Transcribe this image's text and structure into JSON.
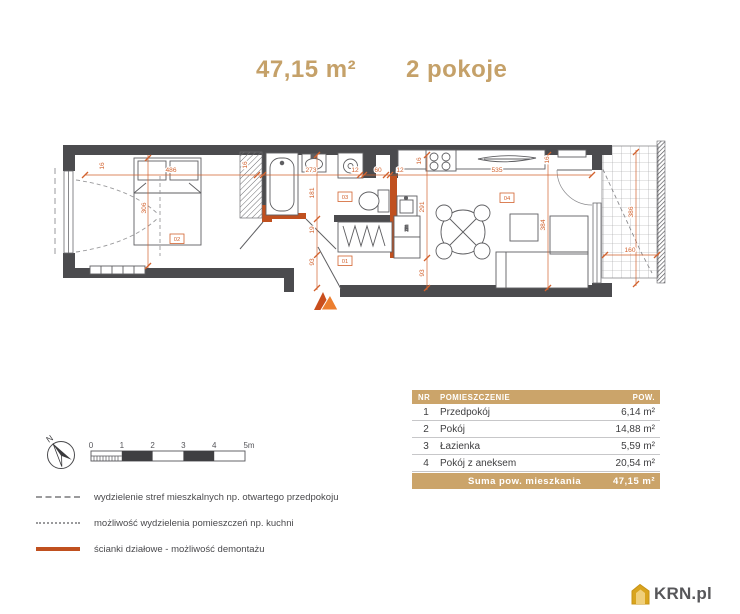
{
  "title": {
    "area": "47,15 m²",
    "rooms_label": "2 pokoje"
  },
  "plan": {
    "colors": {
      "dimension": "#d2622e",
      "wall": "#4b4b4e",
      "demountable_wall": "#c0501f",
      "accent": "#c5a169"
    },
    "room_labels": [
      {
        "id": "02",
        "x": 177,
        "y": 240
      },
      {
        "id": "03",
        "x": 345,
        "y": 198
      },
      {
        "id": "01",
        "x": 345,
        "y": 262
      },
      {
        "id": "04",
        "x": 507,
        "y": 199
      }
    ],
    "dimensions": [
      {
        "text": "16",
        "x": 104,
        "y": 166,
        "rot": -90
      },
      {
        "text": "486",
        "x": 171,
        "y": 172,
        "rot": 0
      },
      {
        "text": "306",
        "x": 146,
        "y": 208,
        "rot": -90
      },
      {
        "text": "16",
        "x": 247,
        "y": 165,
        "rot": -90
      },
      {
        "text": "273",
        "x": 311,
        "y": 172,
        "rot": 0
      },
      {
        "text": "181",
        "x": 314,
        "y": 193,
        "rot": -90
      },
      {
        "text": "12",
        "x": 355,
        "y": 172,
        "rot": 0
      },
      {
        "text": "60",
        "x": 378,
        "y": 172,
        "rot": 0
      },
      {
        "text": "12",
        "x": 400,
        "y": 172,
        "rot": 0
      },
      {
        "text": "16",
        "x": 421,
        "y": 161,
        "rot": -90
      },
      {
        "text": "535",
        "x": 497,
        "y": 172,
        "rot": 0
      },
      {
        "text": "16",
        "x": 549,
        "y": 160,
        "rot": -90
      },
      {
        "text": "291",
        "x": 424,
        "y": 207,
        "rot": -90
      },
      {
        "text": "384",
        "x": 545,
        "y": 225,
        "rot": -90
      },
      {
        "text": "19",
        "x": 314,
        "y": 230,
        "rot": -90
      },
      {
        "text": "93",
        "x": 314,
        "y": 262,
        "rot": -90
      },
      {
        "text": "93",
        "x": 424,
        "y": 273,
        "rot": -90
      },
      {
        "text": "160",
        "x": 630,
        "y": 252,
        "rot": 0
      },
      {
        "text": "386",
        "x": 633,
        "y": 212,
        "rot": -90
      }
    ],
    "appliance_label": "zm"
  },
  "table": {
    "headers": [
      "NR",
      "POMIESZCZENIE",
      "POW."
    ],
    "rows": [
      [
        "1",
        "Przedpokój",
        "6,14 m²"
      ],
      [
        "2",
        "Pokój",
        "14,88 m²"
      ],
      [
        "3",
        "Łazienka",
        "5,59 m²"
      ],
      [
        "4",
        "Pokój z aneksem",
        "20,54 m²"
      ]
    ],
    "sum_label": "Suma pow. mieszkania",
    "sum_value": "47,15 m²"
  },
  "legend": {
    "items": [
      {
        "style": "dashed",
        "label": "wydzielenie stref mieszkalnych np. otwartego przedpokoju"
      },
      {
        "style": "dotted",
        "label": "możliwość wydzielenia pomieszczeń np. kuchni"
      },
      {
        "style": "solid",
        "label": "ścianki działowe - możliwość demontażu"
      }
    ]
  },
  "scale_bar": {
    "ticks": [
      "0",
      "1",
      "2",
      "3",
      "4",
      "5m"
    ]
  },
  "compass": {
    "label": "N"
  },
  "logo": {
    "text": "KRN.pl"
  }
}
